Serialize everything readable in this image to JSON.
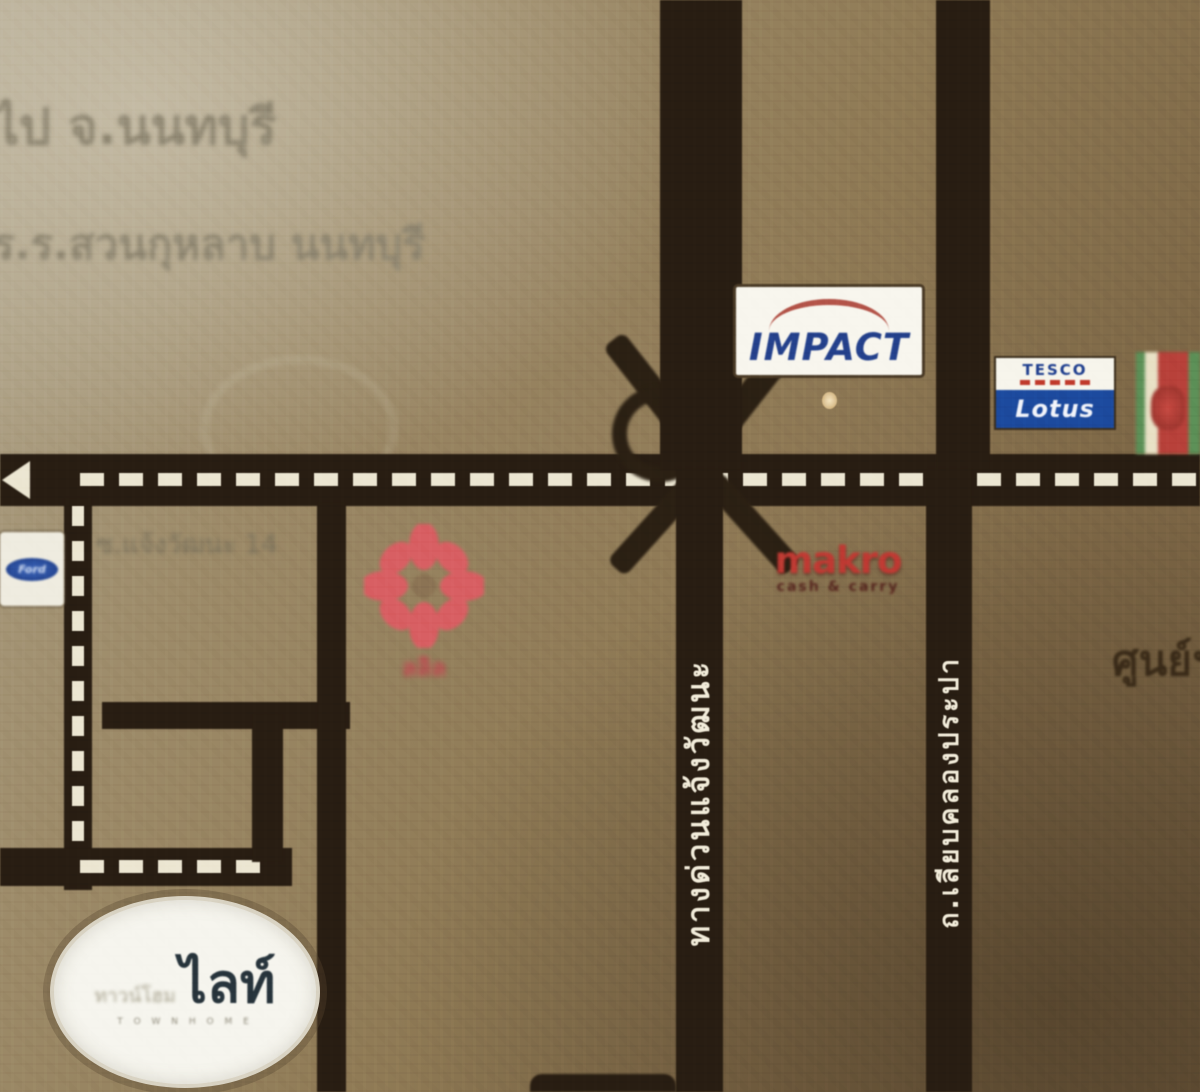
{
  "map": {
    "ghost_texts": {
      "line1": "ไป จ.นนทบุรี",
      "line2": "ร.ร.สวนกุหลาบ นนทบุรี",
      "soi_label": "ซ.แจ้งวัฒนะ 14",
      "right_edge_label": "ศูนย์ฯ"
    },
    "roads": {
      "expressway_label": "ทางด่วนแจ้งวัฒนะ",
      "canal_road_label": "ถ.เลียบคลองประปา",
      "road_color": "#281d12",
      "dash_color": "#ece6d2"
    },
    "landmarks": {
      "impact": {
        "label": "IMPACT",
        "text_color": "#24418c",
        "arc_color": "#a8372c"
      },
      "tesco_lotus": {
        "top_label": "TESCO",
        "bottom_label": "Lotus",
        "band_color": "#1c4a9e"
      },
      "makro": {
        "label": "makro",
        "sub_label": "cash & carry",
        "color": "#bf3a33"
      },
      "flower_logo": {
        "label": "ลลิล",
        "color": "#d85f63"
      },
      "dealer_logo": {
        "label": "Ford",
        "oval_color": "#1e3c85"
      },
      "project_oval": {
        "small_text": "ทาวน์โฮม",
        "main_text": "ไลท์",
        "tiny_text": "T O W N H O M E"
      }
    }
  }
}
